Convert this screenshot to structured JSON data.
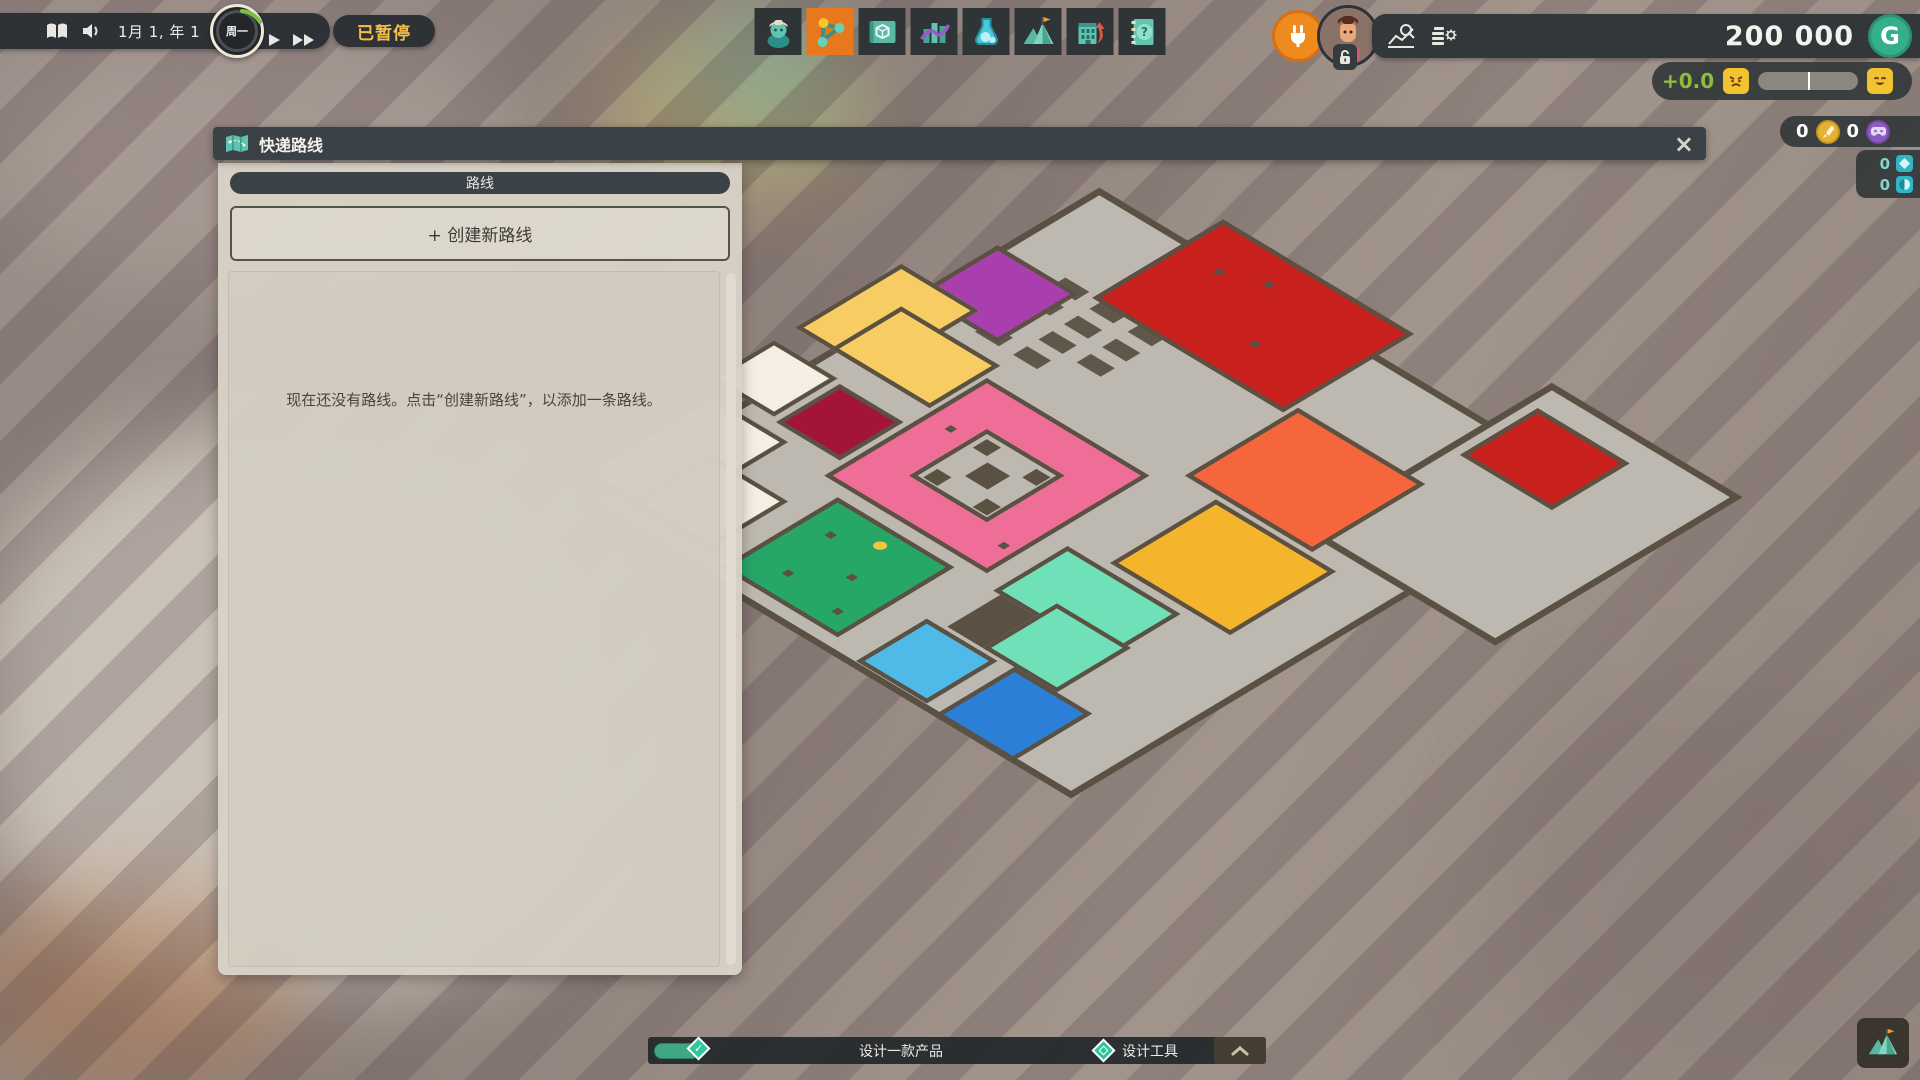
{
  "topbar": {
    "date": "1月 1, 年 1",
    "clock_day": "周一",
    "paused_label": "已暂停",
    "money": "200 000",
    "currency_symbol": "G",
    "mood_value": "+0.0",
    "counter_rocket": "0",
    "counter_controller": "0",
    "counter_diamond": "0",
    "counter_orb": "0"
  },
  "toolbar": {
    "selected_index": 1,
    "items": [
      {
        "name": "staff"
      },
      {
        "name": "delivery-routes"
      },
      {
        "name": "product-blueprints"
      },
      {
        "name": "statistics"
      },
      {
        "name": "research"
      },
      {
        "name": "milestones"
      },
      {
        "name": "building-upgrade"
      },
      {
        "name": "handbook"
      }
    ]
  },
  "panel": {
    "title": "快递路线",
    "close_glyph": "×",
    "tab_label": "路线",
    "create_button": "+ 创建新路线",
    "empty_text": "现在还没有路线。点击“创建新路线”，以添加一条路线。"
  },
  "tasks": {
    "task1": "设计一款产品",
    "task2": "设计工具",
    "check_glyph": "✓"
  },
  "colors": {
    "accent_orange": "#e8781e",
    "paused_yellow": "#f2c14b",
    "mood_green": "#8fbe3f",
    "money_coin_green": "#35ae8c"
  },
  "map": {
    "wall": "#5a5143",
    "floor": "#beb9b0",
    "elements": [
      {
        "name": "floor-main",
        "x": 70,
        "y": 170,
        "w": 700,
        "h": 740,
        "c": "#beb9b0",
        "b": 9
      },
      {
        "name": "floor-east-wing",
        "x": 620,
        "y": 80,
        "w": 270,
        "h": 350,
        "c": "#beb9b0",
        "b": 9
      },
      {
        "name": "desk",
        "x": 152,
        "y": 300,
        "w": 34,
        "h": 20,
        "c": "#5f5749",
        "b": 0
      },
      {
        "name": "desk",
        "x": 206,
        "y": 300,
        "w": 34,
        "h": 20,
        "c": "#5f5749",
        "b": 0
      },
      {
        "name": "desk",
        "x": 260,
        "y": 300,
        "w": 34,
        "h": 20,
        "c": "#5f5749",
        "b": 0
      },
      {
        "name": "desk",
        "x": 152,
        "y": 336,
        "w": 34,
        "h": 20,
        "c": "#5f5749",
        "b": 0
      },
      {
        "name": "desk",
        "x": 206,
        "y": 336,
        "w": 34,
        "h": 20,
        "c": "#5f5749",
        "b": 0
      },
      {
        "name": "desk",
        "x": 260,
        "y": 336,
        "w": 34,
        "h": 20,
        "c": "#5f5749",
        "b": 0
      },
      {
        "name": "desk",
        "x": 206,
        "y": 372,
        "w": 34,
        "h": 20,
        "c": "#5f5749",
        "b": 0
      },
      {
        "name": "desk",
        "x": 260,
        "y": 372,
        "w": 34,
        "h": 20,
        "c": "#5f5749",
        "b": 0
      },
      {
        "name": "desk",
        "x": 152,
        "y": 408,
        "w": 34,
        "h": 20,
        "c": "#5f5749",
        "b": 0
      },
      {
        "name": "desk",
        "x": 206,
        "y": 408,
        "w": 34,
        "h": 20,
        "c": "#5f5749",
        "b": 0
      },
      {
        "name": "room-red",
        "x": 195,
        "y": 120,
        "w": 270,
        "h": 185,
        "c": "#c8211e",
        "b": 6
      },
      {
        "name": "room-red-annex",
        "x": 640,
        "y": 120,
        "w": 130,
        "h": 110,
        "c": "#c8211e",
        "b": 6
      },
      {
        "name": "room-purple",
        "x": 66,
        "y": 310,
        "w": 115,
        "h": 115,
        "c": "#a93fae",
        "b": 6
      },
      {
        "name": "room-yellow-a",
        "x": 20,
        "y": 400,
        "w": 110,
        "h": 150,
        "c": "#f7cd63",
        "b": 6
      },
      {
        "name": "room-yellow-b",
        "x": 70,
        "y": 450,
        "w": 140,
        "h": 100,
        "c": "#f7cd63",
        "b": 6
      },
      {
        "name": "room-cream-a",
        "x": 20,
        "y": 580,
        "w": 90,
        "h": 90,
        "c": "#f5efe3",
        "b": 6
      },
      {
        "name": "room-maroon",
        "x": 118,
        "y": 585,
        "w": 90,
        "h": 90,
        "c": "#a31438",
        "b": 6
      },
      {
        "name": "room-cream-b",
        "x": 40,
        "y": 690,
        "w": 110,
        "h": 180,
        "c": "#f5efe3",
        "b": 6
      },
      {
        "name": "room-cream-c",
        "x": 110,
        "y": 760,
        "w": 110,
        "h": 110,
        "c": "#f5efe3",
        "b": 6
      },
      {
        "name": "room-orange",
        "x": 470,
        "y": 289,
        "w": 180,
        "h": 160,
        "c": "#f5663d",
        "b": 6
      },
      {
        "name": "room-gold",
        "x": 520,
        "y": 455,
        "w": 170,
        "h": 150,
        "c": "#f4b42c",
        "b": 6
      },
      {
        "name": "room-pink",
        "x": 215,
        "y": 474,
        "w": 230,
        "h": 230,
        "c": "#ee6e97",
        "b": 6
      },
      {
        "name": "courtyard",
        "x": 275,
        "y": 534,
        "w": 110,
        "h": 110,
        "c": "#beb9b0",
        "b": 6
      },
      {
        "name": "court-center",
        "x": 315,
        "y": 573,
        "w": 32,
        "h": 32,
        "c": "#5a5143",
        "b": 0
      },
      {
        "name": "court-corner",
        "x": 287,
        "y": 546,
        "w": 20,
        "h": 20,
        "c": "#5a5143",
        "b": 0
      },
      {
        "name": "court-corner",
        "x": 357,
        "y": 546,
        "w": 20,
        "h": 20,
        "c": "#5a5143",
        "b": 0
      },
      {
        "name": "court-corner",
        "x": 287,
        "y": 616,
        "w": 20,
        "h": 20,
        "c": "#5a5143",
        "b": 0
      },
      {
        "name": "court-corner",
        "x": 357,
        "y": 616,
        "w": 20,
        "h": 20,
        "c": "#5a5143",
        "b": 0
      },
      {
        "name": "room-green",
        "x": 250,
        "y": 720,
        "w": 165,
        "h": 165,
        "c": "#27a767",
        "b": 6
      },
      {
        "name": "room-mint-a",
        "x": 470,
        "y": 615,
        "w": 160,
        "h": 105,
        "c": "#6fe0b8",
        "b": 6
      },
      {
        "name": "room-mint-b",
        "x": 530,
        "y": 690,
        "w": 105,
        "h": 105,
        "c": "#6fe0b8",
        "b": 6
      },
      {
        "name": "room-lightblue",
        "x": 456,
        "y": 800,
        "w": 100,
        "h": 100,
        "c": "#4fb9e8",
        "b": 6
      },
      {
        "name": "room-blue",
        "x": 575,
        "y": 795,
        "w": 110,
        "h": 112,
        "c": "#2c7fd6",
        "b": 6
      },
      {
        "name": "storage-block",
        "x": 480,
        "y": 720,
        "w": 50,
        "h": 75,
        "c": "#5a5143",
        "b": 0
      },
      {
        "name": "dot",
        "x": 250,
        "y": 180,
        "w": 9,
        "h": 9,
        "c": "#5a5143",
        "b": 0
      },
      {
        "name": "dot",
        "x": 360,
        "y": 240,
        "w": 9,
        "h": 9,
        "c": "#5a5143",
        "b": 0
      },
      {
        "name": "dot",
        "x": 300,
        "y": 160,
        "w": 9,
        "h": 9,
        "c": "#5a5143",
        "b": 0
      },
      {
        "name": "dot",
        "x": 245,
        "y": 555,
        "w": 9,
        "h": 9,
        "c": "#5a5143",
        "b": 0
      },
      {
        "name": "dot",
        "x": 420,
        "y": 655,
        "w": 9,
        "h": 9,
        "c": "#5a5143",
        "b": 0
      },
      {
        "name": "dot",
        "x": 285,
        "y": 765,
        "w": 9,
        "h": 9,
        "c": "#5a5143",
        "b": 0
      },
      {
        "name": "dot",
        "x": 350,
        "y": 800,
        "w": 9,
        "h": 9,
        "c": "#5a5143",
        "b": 0
      },
      {
        "name": "dot",
        "x": 300,
        "y": 840,
        "w": 9,
        "h": 9,
        "c": "#5a5143",
        "b": 0
      },
      {
        "name": "dot",
        "x": 380,
        "y": 850,
        "w": 9,
        "h": 9,
        "c": "#5a5143",
        "b": 0
      },
      {
        "name": "route-marker",
        "x": 330,
        "y": 740,
        "w": 14,
        "h": 14,
        "c": "#f2c63d",
        "b": 0,
        "r": true
      }
    ]
  }
}
